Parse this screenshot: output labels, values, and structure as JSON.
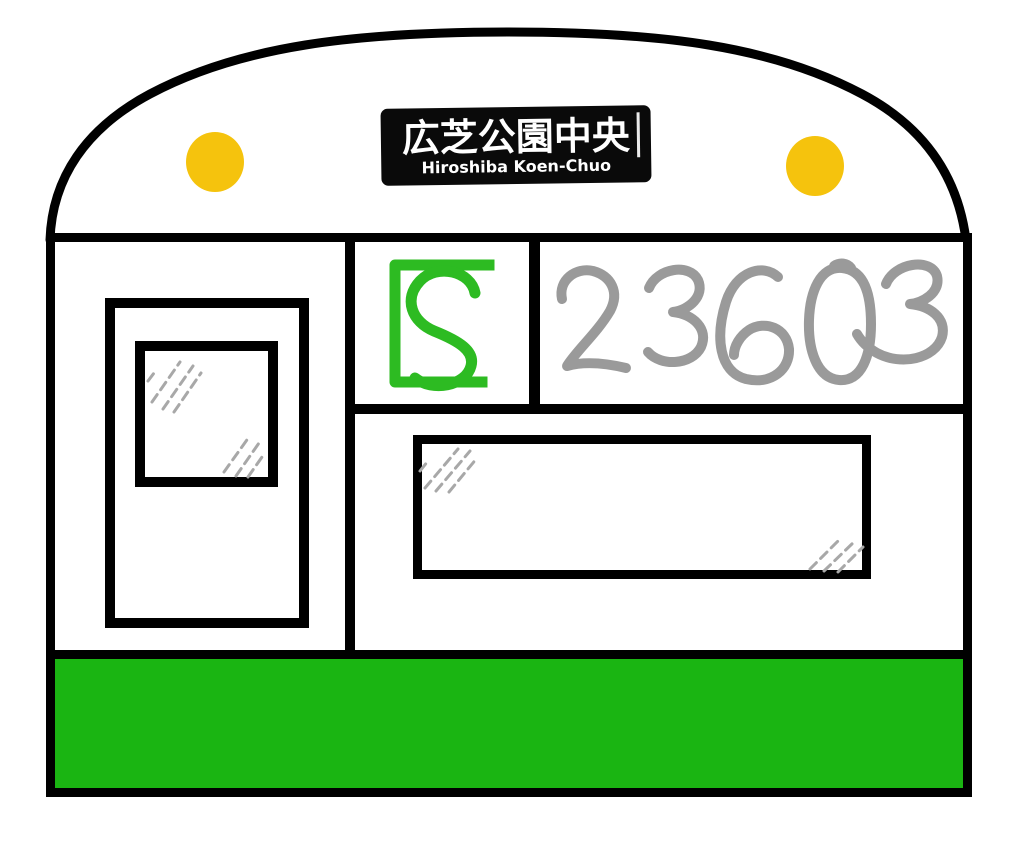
{
  "illustration": {
    "destination_sign": {
      "japanese": "広芝公園中央",
      "romaji": "Hiroshiba Koen-Chuo"
    },
    "car_number": "23603",
    "logo_letter": "S"
  },
  "colors": {
    "outline": "#000000",
    "body": "#FFFFFF",
    "stripe_green": "#1AB512",
    "logo_green": "#2DBB22",
    "headlight_yellow": "#F5C30D",
    "number_gray": "#9A9A9A",
    "sign_bg": "#0A0A0A",
    "sign_text": "#FFFFFF",
    "glass_streak": "#A8A8A8"
  }
}
